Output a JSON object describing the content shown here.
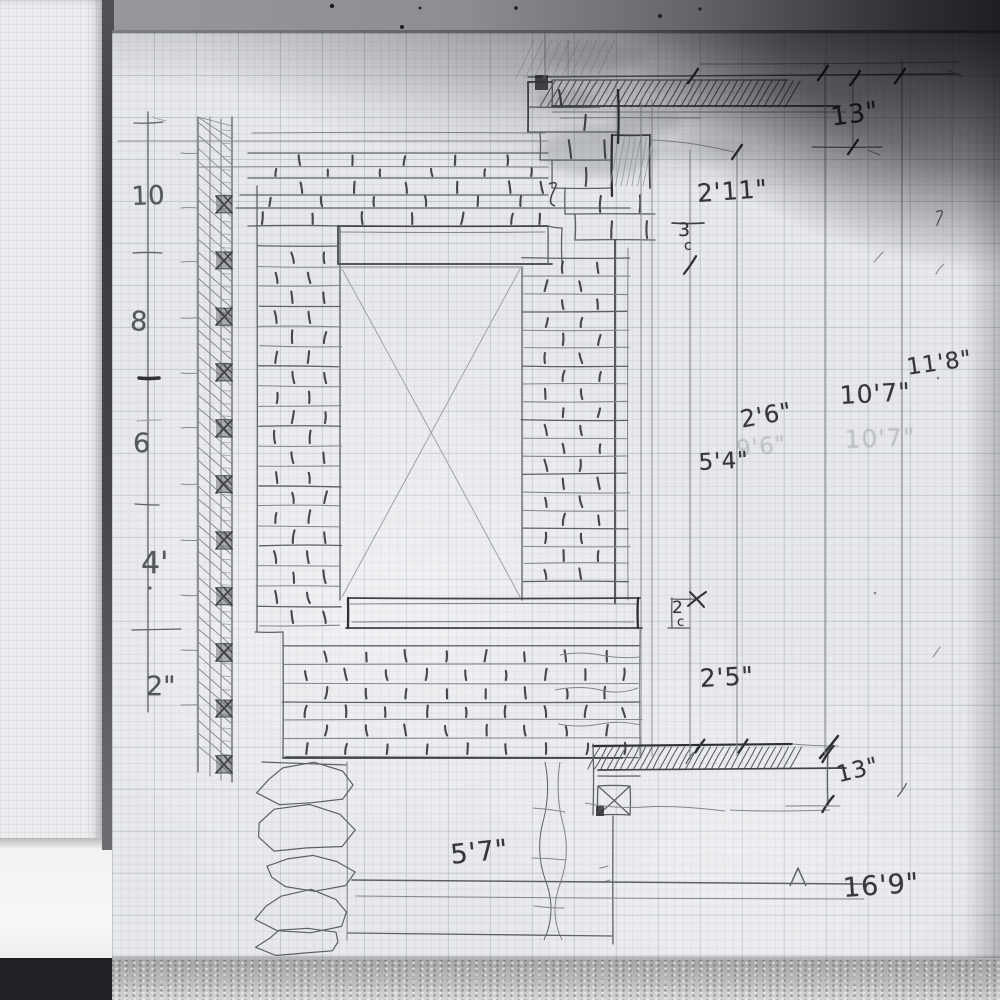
{
  "scene": {
    "kind": "hand-drawn pencil sketch on graph paper",
    "subject": "brick fireplace chimney elevation with wall section and dimension lines"
  },
  "ruler": {
    "labels": {
      "r10": "10",
      "r8": "8",
      "r6": "6",
      "r4": "4'",
      "r2": "2\""
    }
  },
  "labels": {
    "dim_top_13": "13\"",
    "dim_2_11": "2'11\"",
    "course_3": "3",
    "course_c1": "c",
    "dim_2_6": "2'6\"",
    "ghost_9_6": "9'6\"",
    "dim_5_4": "5'4\"",
    "dim_10_7": "10'7\"",
    "ghost_10_7": "10'7\"",
    "dim_11_8": "11'8\"",
    "course_2": "2",
    "course_c2": "c",
    "dim_2_5": "2'5\"",
    "dim_13_hearth": "13\"",
    "dim_16_9": "16'9\"",
    "dim_5_7": "5'7\""
  }
}
